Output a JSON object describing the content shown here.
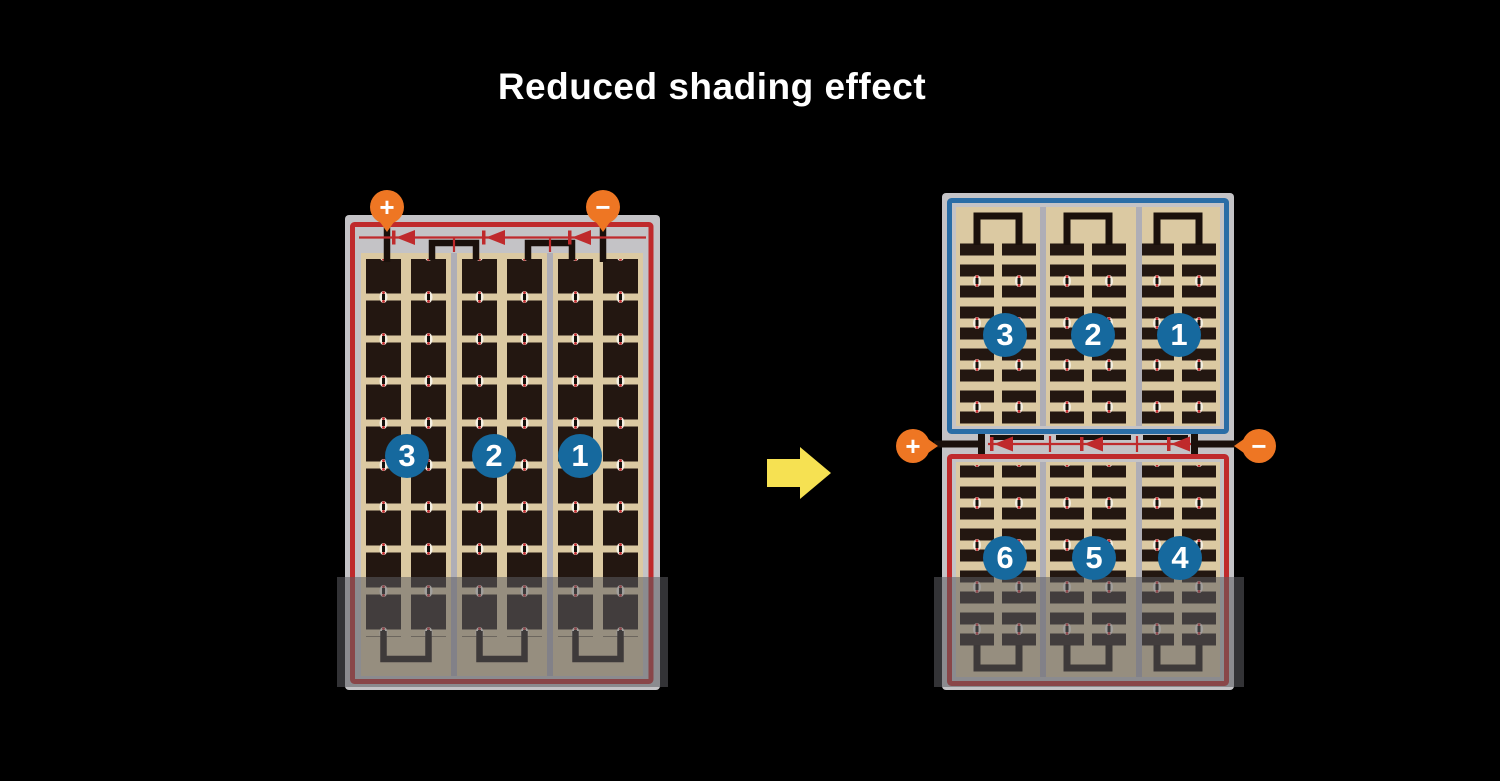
{
  "title": "Reduced shading effect",
  "left_panel": {
    "description": "conventional full-cell module, fully shaded across bottom",
    "terminal_plus": "+",
    "terminal_minus": "−",
    "string_labels": [
      "3",
      "2",
      "1"
    ],
    "shaded": true
  },
  "right_panel": {
    "description": "half-cut cell module split into top and bottom halves",
    "terminal_plus": "+",
    "terminal_minus": "−",
    "top_string_labels": [
      "3",
      "2",
      "1"
    ],
    "bottom_string_labels": [
      "6",
      "5",
      "4"
    ],
    "shaded_bottom": true
  },
  "icons": {
    "arrow": "right-arrow-icon",
    "diode": "bypass-diode-icon"
  },
  "colors": {
    "background": "#000000",
    "title_text": "#ffffff",
    "terminal_orange": "#ee7623",
    "string_circle_blue": "#16699e",
    "wiring_red": "#bf2a2c",
    "top_half_border_blue": "#2a6da6",
    "cell_tan": "#dbc9a2",
    "cell_dark": "#231711",
    "frame_gray": "#c4c3c6",
    "separator_gray": "#afaeb6",
    "arrow_yellow": "#f6e152"
  }
}
